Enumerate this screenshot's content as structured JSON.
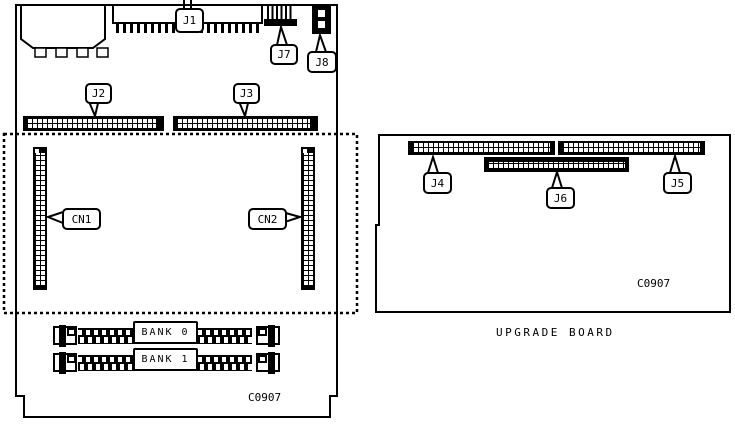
{
  "main_board": {
    "connector_labels": {
      "j1": "J1",
      "j2": "J2",
      "j3": "J3",
      "j7": "J7",
      "j8": "J8",
      "cn1": "CN1",
      "cn2": "CN2"
    },
    "memory_banks": {
      "bank0": "BANK 0",
      "bank1": "BANK 1"
    },
    "ref_code": "C0907"
  },
  "upgrade_board": {
    "caption": "UPGRADE BOARD",
    "connector_labels": {
      "j4": "J4",
      "j5": "J5",
      "j6": "J6"
    },
    "ref_code": "C0907"
  },
  "colors": {
    "line": "#000000",
    "background": "#ffffff"
  }
}
